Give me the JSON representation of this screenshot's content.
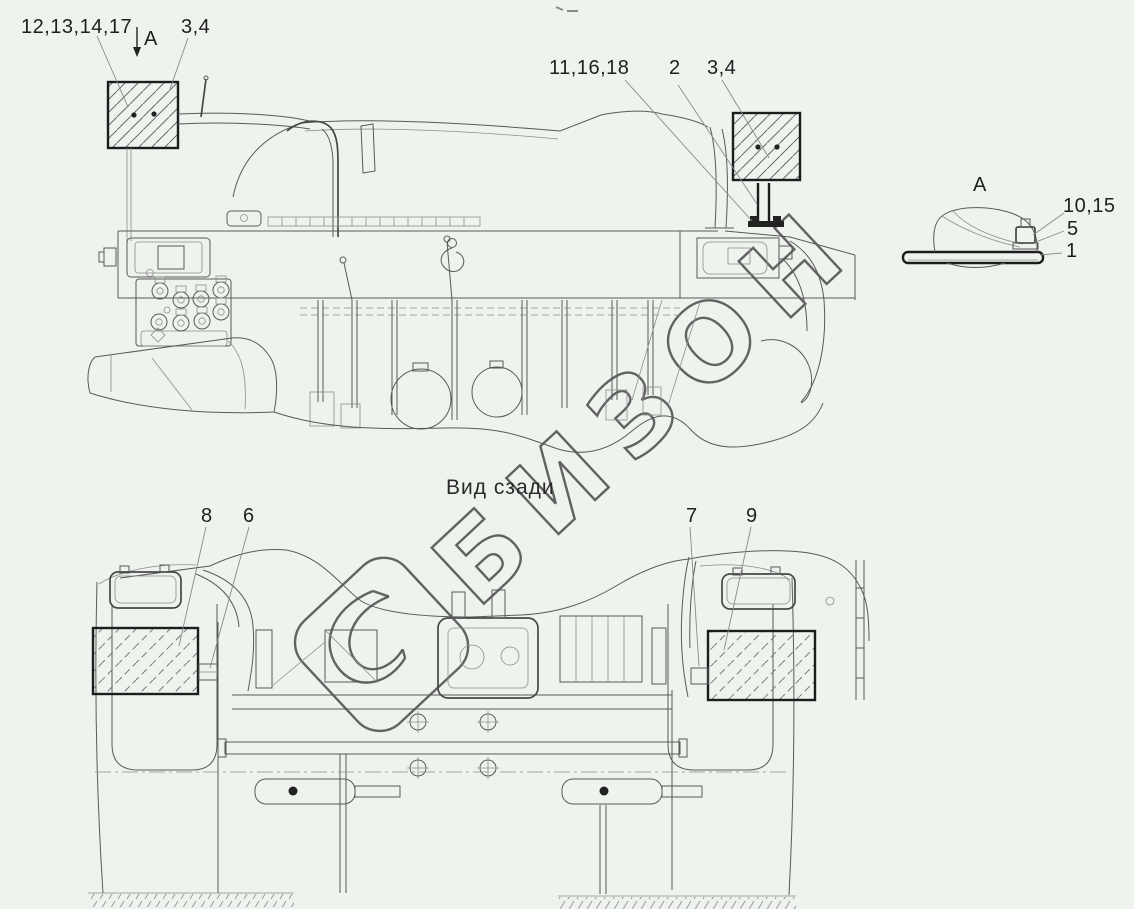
{
  "labels": {
    "parts_top_left": "12,13,14,17",
    "view_arrow": "A",
    "mirror_top_left": "3,4",
    "parts_top_right": "11,16,18",
    "stand_top_right": "2",
    "mirror_top_right": "3,4",
    "detail_title": "A",
    "detail_top": "10,15",
    "detail_mid": "5",
    "detail_bottom": "1",
    "rear_caption": "Вид сзади",
    "rear_left_flap": "8",
    "rear_left_bracket": "6",
    "rear_right_bracket": "7",
    "rear_right_flap": "9"
  },
  "watermark": {
    "text": "БИЗОН"
  },
  "colors": {
    "background": "#eef3ee",
    "line": "#5a5a5a",
    "label": "#1f1f1f",
    "watermark": "#4f4f4f",
    "accent_dark": "#1d1d1d"
  }
}
